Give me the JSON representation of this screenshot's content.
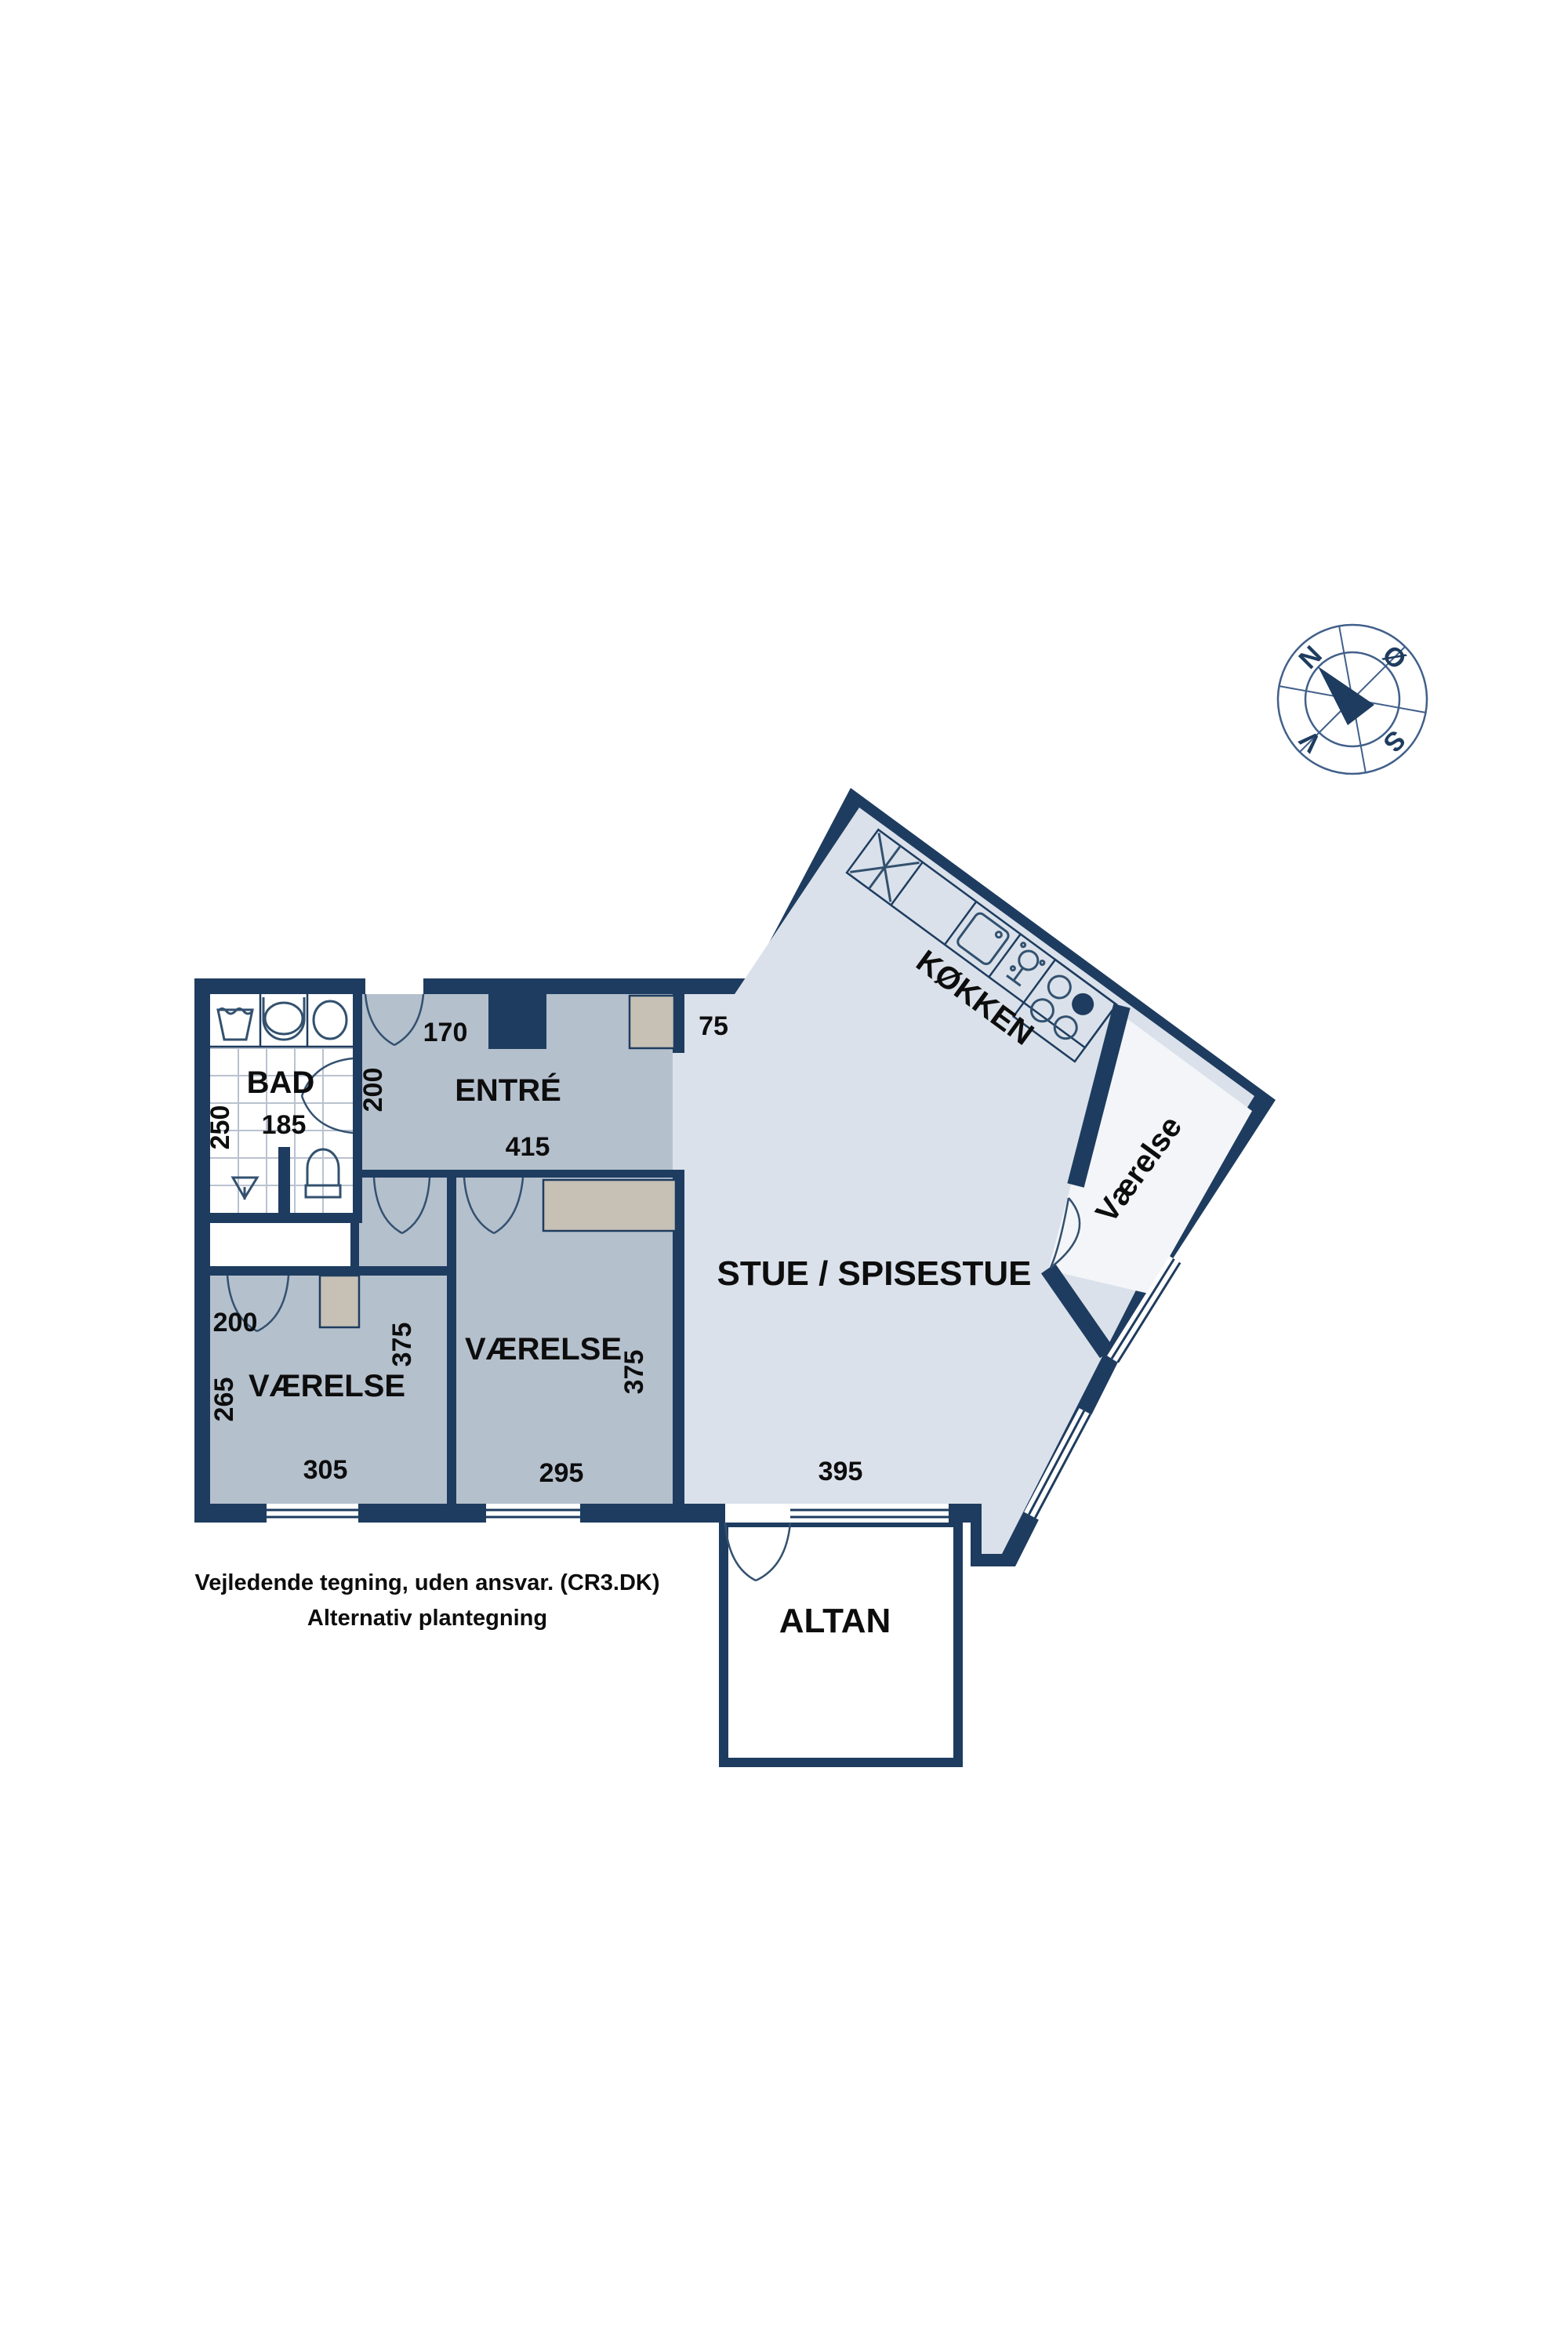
{
  "title": "Alternativ plantegning (floor plan)",
  "colors": {
    "wall_navy": "#1e3c5f",
    "floor_gray_blue": "#b5c0cd",
    "floor_light_blue": "#dae1ea",
    "floor_white_room": "#f4f5f8",
    "wardrobe_tan": "#c6c0b5",
    "text_black": "#0d0d0d"
  },
  "rooms": {
    "bad": "BAD",
    "entre": "ENTRÉ",
    "vaerelse_left": "VÆRELSE",
    "vaerelse_mid": "VÆRELSE",
    "vaerelse_rotated": "Værelse",
    "stue": "STUE / SPISESTUE",
    "koekken": "KØKKEN",
    "altan": "ALTAN"
  },
  "measurements": {
    "bad_width": "185",
    "bad_depth": "250",
    "entre_door": "170",
    "entre_height": "200",
    "entre_width": "415",
    "wall_stub": "75",
    "closet_width": "200",
    "left_room_left": "265",
    "left_room_right": "375",
    "left_room_width": "305",
    "mid_room_width": "295",
    "mid_room_right": "375",
    "stue_width": "395"
  },
  "compass": {
    "north": "N",
    "east": "Ø",
    "south": "S",
    "west": "V"
  },
  "footer": {
    "line1": "Vejledende tegning, uden ansvar. (CR3.DK)",
    "line2": "Alternativ plantegning"
  }
}
